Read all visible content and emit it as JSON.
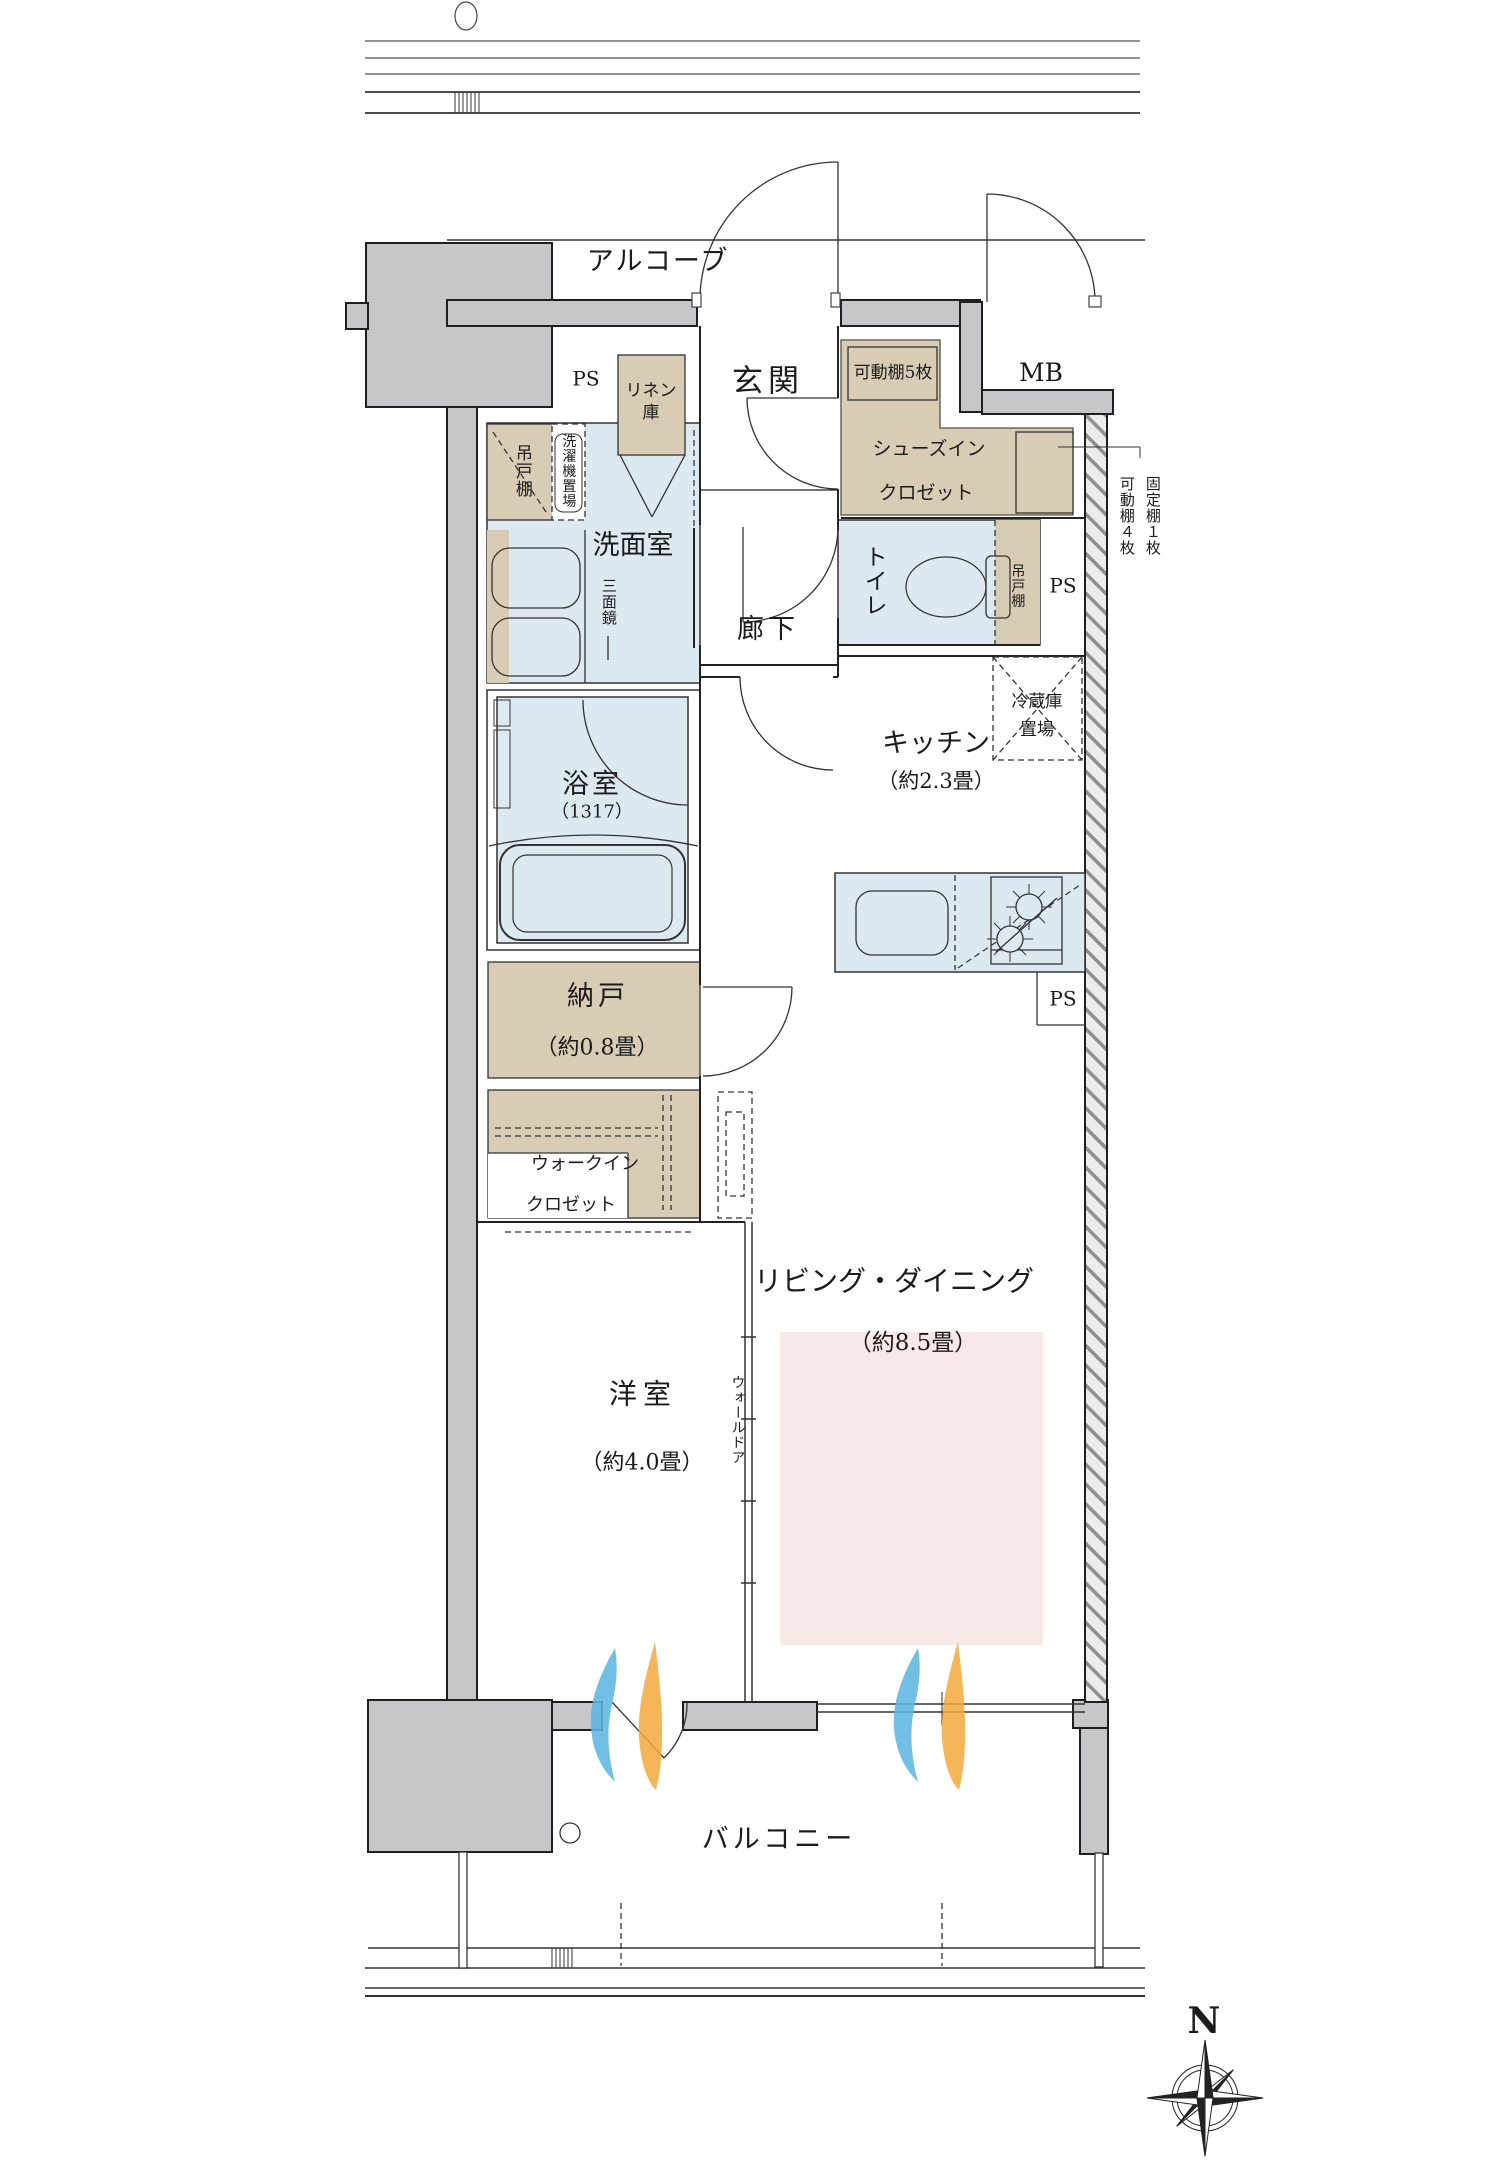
{
  "floor_plan": {
    "rooms": {
      "alcove": "アルコーブ",
      "entrance": "玄関",
      "shoes_closet_line1": "シューズイン",
      "shoes_closet_line2": "クロゼット",
      "washroom": "洗面室",
      "corridor": "廊下",
      "toilet": "トイレ",
      "bath": "浴室",
      "bath_size": "（1317）",
      "kitchen": "キッチン",
      "kitchen_size": "（約2.3畳）",
      "storage": "納戸",
      "storage_size": "（約0.8畳）",
      "walkin_line1": "ウォークイン",
      "walkin_line2": "クロゼット",
      "living_dining": "リビング・ダイニング",
      "living_dining_size": "（約8.5畳）",
      "bedroom": "洋室",
      "bedroom_size": "（約4.0畳）",
      "balcony": "バルコニー"
    },
    "fixtures": {
      "linen_line1": "リネン",
      "linen_line2": "庫",
      "hanging_cabinet_washroom": "吊戸棚",
      "washer_space": "洗濯機置場",
      "triple_mirror": "三面鏡",
      "movable_shelf_5": "可動棚5枚",
      "hanging_cabinet_toilet": "吊戸棚",
      "fridge_space_line1": "冷蔵庫",
      "fridge_space_line2": "置場",
      "fixed_shelf_note": "固定棚１枚",
      "movable_shelf_note": "可動棚４枚",
      "wall_door": "ウォールドア"
    },
    "labels": {
      "ps_top": "PS",
      "ps_toilet": "PS",
      "ps_kitchen": "PS",
      "mb": "MB",
      "north": "N"
    },
    "colors": {
      "wall": "#c7c7c9",
      "wet_area": "#dde9f1",
      "storage_tan": "#d9ccb4",
      "living_pink": "#f8e8e7",
      "flame_blue": "#5fb7e3",
      "flame_orange": "#f2a93b",
      "line": "#222222"
    }
  }
}
